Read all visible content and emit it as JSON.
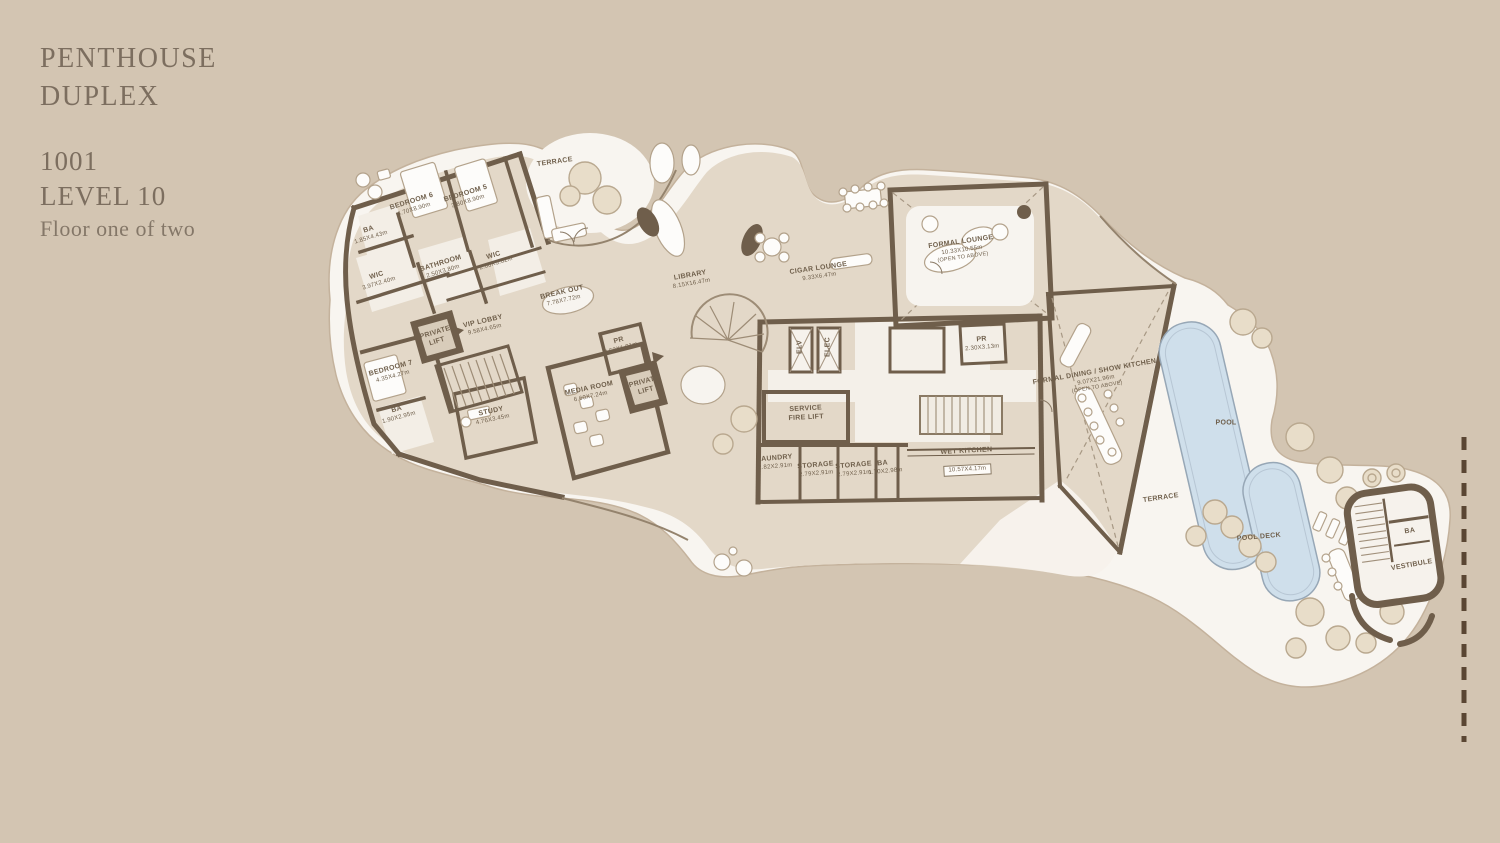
{
  "title": {
    "line1": "PENTHOUSE",
    "line2": "DUPLEX",
    "unit": "1001",
    "level": "LEVEL 10",
    "floor_note": "Floor one of two"
  },
  "colors": {
    "background": "#d3c5b2",
    "terrace_white": "#f8f5f0",
    "floor_beige": "#e3d8c8",
    "wall": "#6f5e4b",
    "label_text": "#6f5f4b",
    "pool_water": "#cfdfeb",
    "tree_fill": "#e8ddc9",
    "property_line": "#5a4633"
  },
  "plan": {
    "labels": [
      {
        "name": "TERRACE"
      },
      {
        "name": "BEDROOM 6",
        "dims": "4.70X8.90m"
      },
      {
        "name": "BEDROOM 5",
        "dims": "3.80X8.90m"
      },
      {
        "name": "BA",
        "dims": "1.85X4.43m"
      },
      {
        "name": "WIC",
        "dims": "3.97X2.40m"
      },
      {
        "name": "BATHROOM",
        "dims": "2.50X3.80m"
      },
      {
        "name": "WIC",
        "dims": "2.60X3.62m"
      },
      {
        "name": "BREAK OUT",
        "dims": "7.78X7.72m"
      },
      {
        "name": "VIP LOBBY",
        "dims": "9.58X4.65m"
      },
      {
        "name": "PRIVATE LIFT"
      },
      {
        "name": "BEDROOM 7",
        "dims": "4.35X4.27m"
      },
      {
        "name": "BA",
        "dims": "1.90X2.95m"
      },
      {
        "name": "STUDY",
        "dims": "4.76X3.45m"
      },
      {
        "name": "MEDIA ROOM",
        "dims": "6.60X7.24m"
      },
      {
        "name": "PR",
        "dims": "2.52X1.91m"
      },
      {
        "name": "PRIVATE LIFT"
      },
      {
        "name": "LIBRARY",
        "dims": "8.15X16.47m"
      },
      {
        "name": "CIGAR LOUNGE",
        "dims": "9.33X6.47m"
      },
      {
        "name": "FORMAL LOUNGE",
        "dims": "10.33X10.55m",
        "note": "(OPEN TO ABOVE)"
      },
      {
        "name": "FORMAL DINING / SHOW KITCHEN",
        "dims": "9.07X21.96m",
        "note": "(OPEN TO ABOVE)"
      },
      {
        "name": "ELV"
      },
      {
        "name": "ELEC"
      },
      {
        "name": "SERVICE FIRE LIFT"
      },
      {
        "name": "PR",
        "dims": "2.30X3.13m"
      },
      {
        "name": "LAUNDRY",
        "dims": "2.82X2.91m"
      },
      {
        "name": "STORAGE",
        "dims": "2.79X2.91m"
      },
      {
        "name": "STORAGE",
        "dims": "2.79X2.91m"
      },
      {
        "name": "BA",
        "dims": "1.70X2.98m"
      },
      {
        "name": "WET KITCHEN",
        "dims": "10.57X4.17m"
      },
      {
        "name": "TERRACE"
      },
      {
        "name": "POOL"
      },
      {
        "name": "POOL DECK"
      },
      {
        "name": "BA"
      },
      {
        "name": "VESTIBULE"
      }
    ]
  }
}
